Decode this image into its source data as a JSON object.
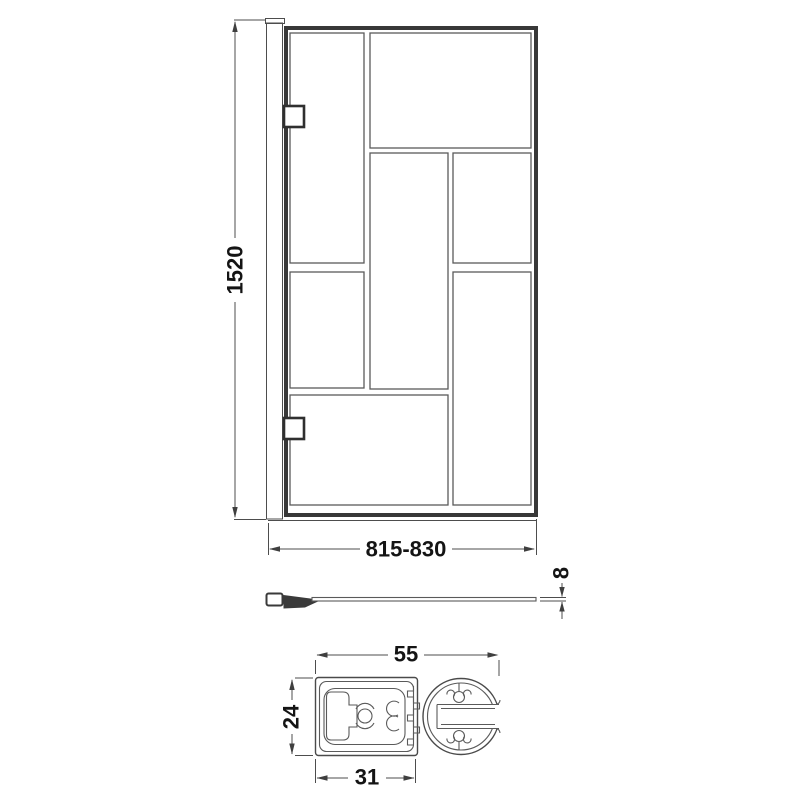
{
  "dimensions": {
    "front_height": "1520",
    "front_width": "815-830",
    "glass_thickness": "8",
    "section_width": "55",
    "section_height": "24",
    "section_inner_width": "31"
  },
  "colors": {
    "line": "#4a4a4a",
    "line_strong": "#383838",
    "text": "#141414",
    "background": "#ffffff"
  }
}
